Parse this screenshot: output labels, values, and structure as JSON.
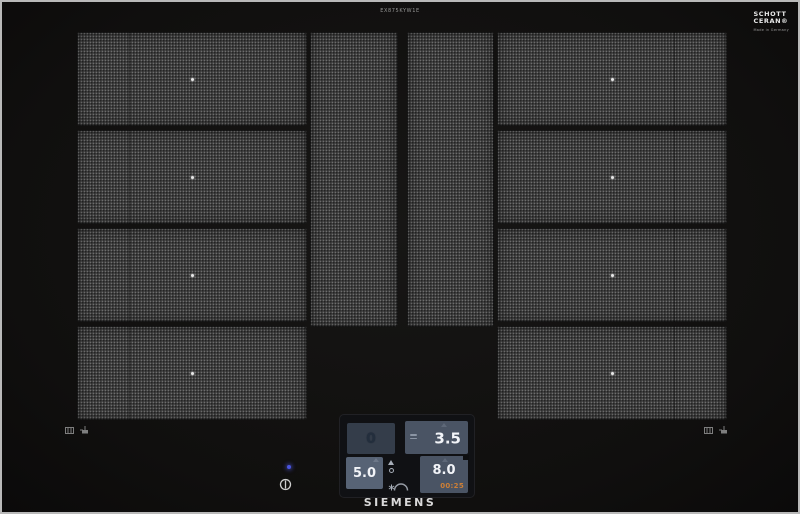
{
  "frame": {
    "model_text": "EX875KYW1E"
  },
  "branding": {
    "siemens_logo": "SIEMENS",
    "glass_line1": "SCHOTT",
    "glass_line2": "CERAN®",
    "glass_subline": "Made in Germany"
  },
  "surface": {
    "left_zone_rows": 4,
    "right_zone_rows": 4,
    "middle_strips": 2,
    "zone_center_marker": "white-dot"
  },
  "control_panel": {
    "rear_left": {
      "value": "0",
      "active": false
    },
    "rear_right": {
      "value": "3.5",
      "active": true
    },
    "front_left": {
      "value": "5.0",
      "active": true
    },
    "front_right": {
      "value": "8.0",
      "timer": "00:25",
      "active": true
    },
    "center_icons": [
      "arrow-up-icon",
      "circle-icon",
      "snowflake-icon",
      "arc-icon"
    ]
  },
  "indicators": {
    "power_led": "blue-dot",
    "power_symbol": "circle-with-line"
  },
  "markings": {
    "left": [
      "induction-coil-icon",
      "pan-icon"
    ],
    "right": [
      "induction-coil-icon",
      "pan-icon"
    ]
  },
  "colors": {
    "glass": "#11100f",
    "zone_texture": "#3a3a3a",
    "tile_active": "#4a5464",
    "tile_bright": "#576375",
    "tile_inactive": "#343d4a",
    "timer_orange": "#cd7f36",
    "led_blue": "#4a55e0",
    "text_white": "#f2f4f8"
  }
}
